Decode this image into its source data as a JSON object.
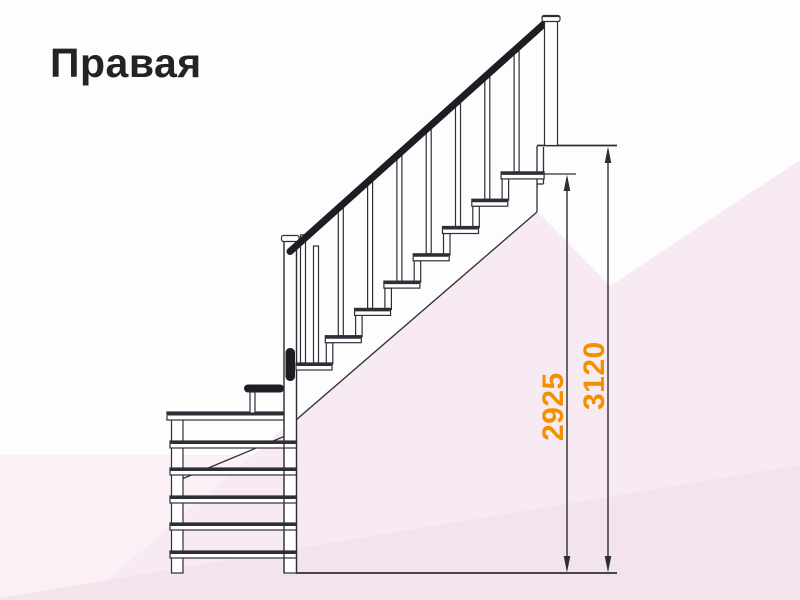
{
  "title": "Правая",
  "diagram": {
    "type": "staircase-side-view",
    "description": "Right-hand L-shaped staircase with lower winder steps, straight railed flight and upper landing",
    "dimensions": {
      "inner": "2925",
      "outer": "3120"
    }
  },
  "colors": {
    "accent_orange": "#F09200",
    "line_dark": "#2E2E36",
    "handrail_dark": "#1D1D24",
    "background_pink": "#F8EAF2"
  }
}
